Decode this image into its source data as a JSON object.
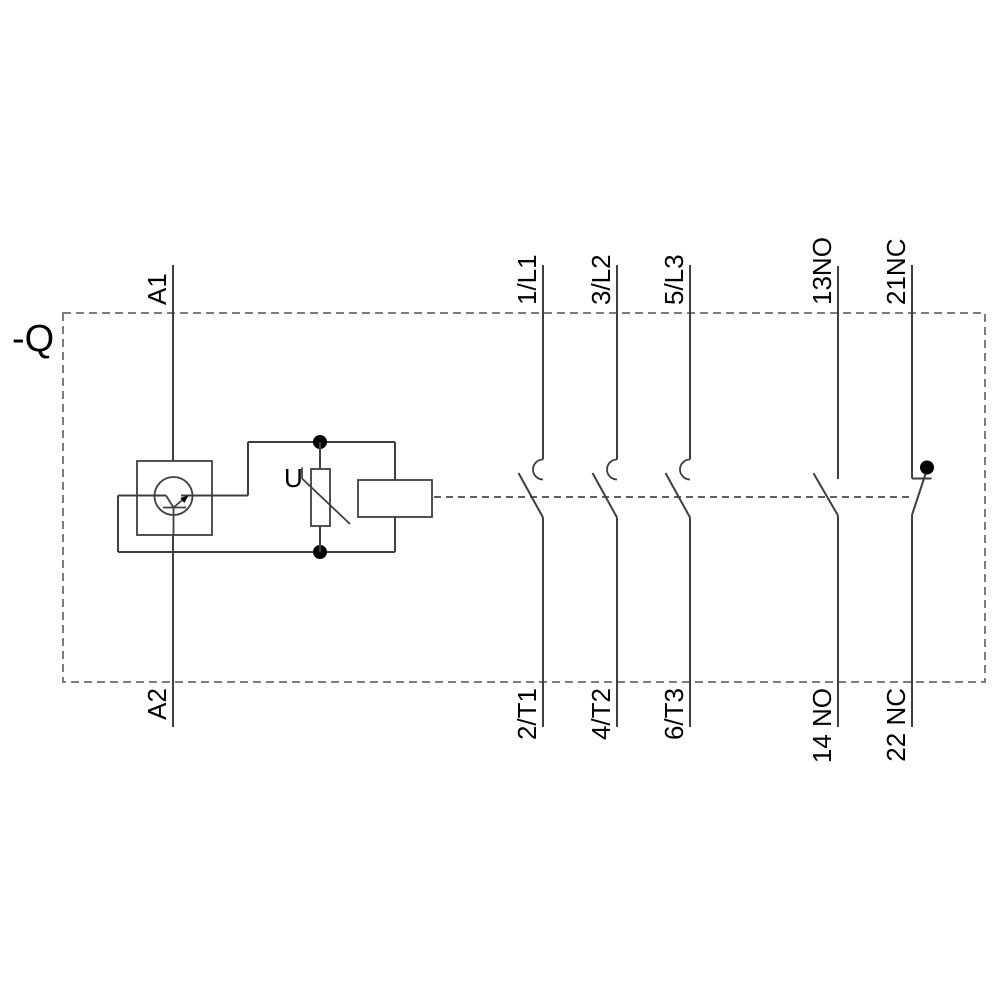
{
  "device": {
    "label": "-Q"
  },
  "suppressor": {
    "label": "U"
  },
  "poles": [
    {
      "name": "coil",
      "top": "A1",
      "bottom": "A2"
    },
    {
      "name": "main-pole-1",
      "top": "1/L1",
      "bottom": "2/T1"
    },
    {
      "name": "main-pole-2",
      "top": "3/L2",
      "bottom": "4/T2"
    },
    {
      "name": "main-pole-3",
      "top": "5/L3",
      "bottom": "6/T3"
    },
    {
      "name": "aux-no",
      "top": "13NO",
      "bottom": "14 NO"
    },
    {
      "name": "aux-nc",
      "top": "21NC",
      "bottom": "22 NC"
    }
  ],
  "colors": {
    "background": "#ffffff",
    "wire": "#3f3f3f",
    "boundary_dash": "#7d7d7d",
    "text": "#000000",
    "junction_dot": "#000000"
  }
}
